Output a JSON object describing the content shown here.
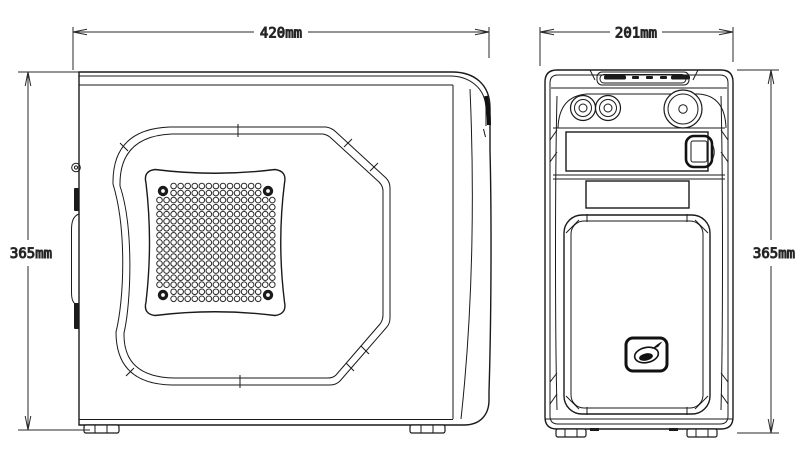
{
  "drawing": {
    "type": "technical-dimension-drawing",
    "subject": "computer-case",
    "background": "#ffffff",
    "line_color": "#1a1a1a",
    "dimensions": {
      "side_width": {
        "label": "420mm"
      },
      "front_width": {
        "label": "201mm"
      },
      "side_height": {
        "label": "365mm"
      },
      "front_height": {
        "label": "365mm"
      }
    },
    "side_view": {
      "vent": {
        "x0": 159.5,
        "y0": 186,
        "cols": 17,
        "rows": 17,
        "dx": 7.05,
        "dy": 7.05,
        "hole_radius": 2.8,
        "hole_color": "#2a2a2a",
        "screw_color": "#1a1a1a",
        "screw_radius": 5.2,
        "screw_hole_radius": 1.9,
        "screw_clearance": 9.5,
        "screws": [
          [
            163,
            191
          ],
          [
            268,
            191
          ],
          [
            163,
            295
          ],
          [
            268,
            295
          ]
        ]
      }
    }
  }
}
